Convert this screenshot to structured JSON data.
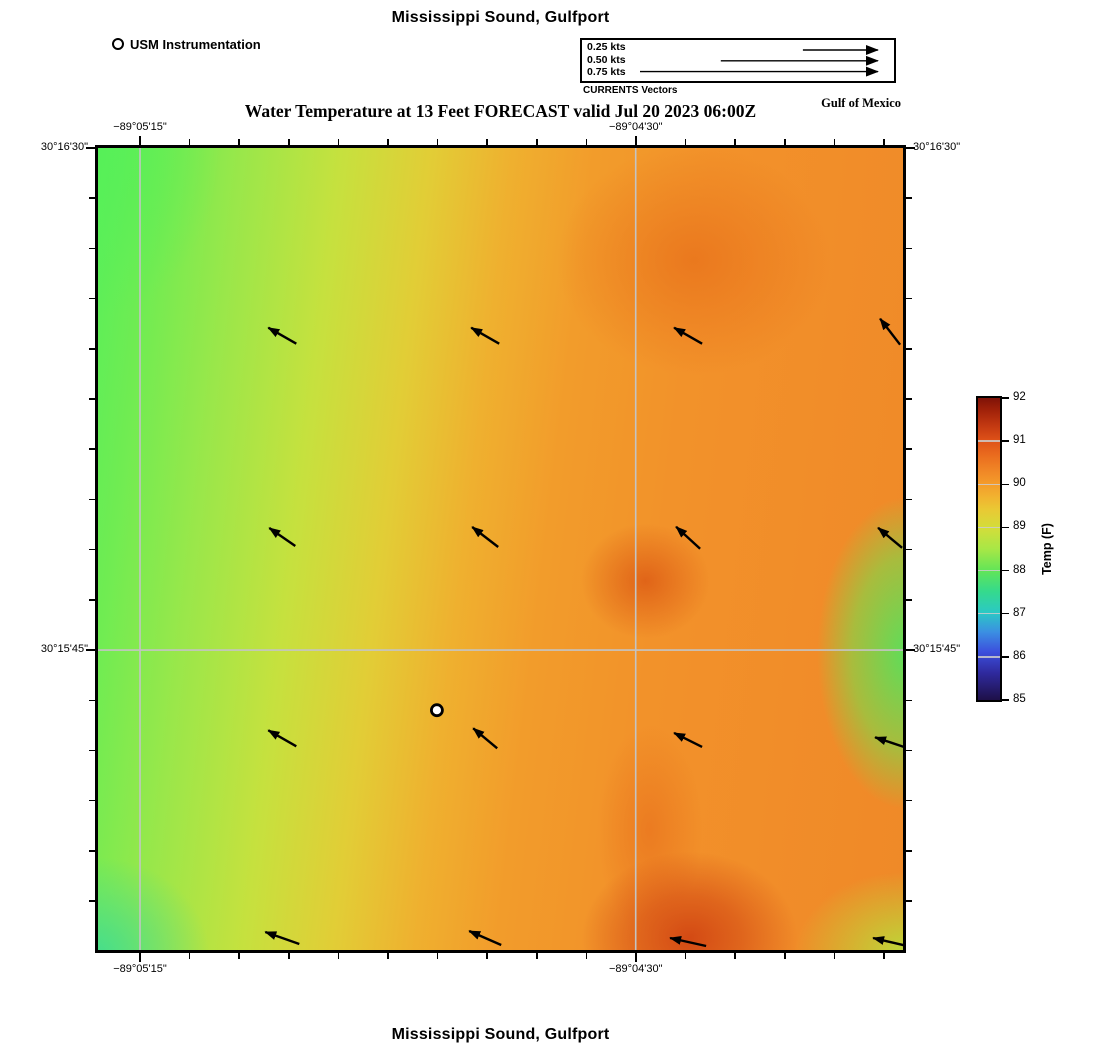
{
  "titles": {
    "top": "Mississippi Sound, Gulfport",
    "subtitle": "Water Temperature at 13 Feet FORECAST valid Jul 20 2023 06:00Z",
    "bottom": "Mississippi Sound, Gulfport",
    "gulf": "Gulf of Mexico"
  },
  "legend": {
    "instrument": "USM Instrumentation",
    "vectors": {
      "caption": "CURRENTS Vectors",
      "items": [
        {
          "label": "0.25 kts",
          "line_start_frac": 0.708
        },
        {
          "label": "0.50 kts",
          "line_start_frac": 0.445
        },
        {
          "label": "0.75 kts",
          "line_start_frac": 0.186
        }
      ],
      "line_end_frac": 0.987
    }
  },
  "axes": {
    "x": {
      "first_tick_frac": 0.0522,
      "step_frac": 0.06161,
      "count": 16,
      "major_indices": [
        0,
        10
      ],
      "labels": [
        {
          "text": "−89°05'15\"",
          "frac": 0.0522
        },
        {
          "text": "−89°04'30\"",
          "frac": 0.668
        }
      ]
    },
    "y": {
      "first_tick_frac": 0.0,
      "step_frac": 0.0626,
      "count": 16,
      "major_indices": [
        0,
        10
      ],
      "labels": [
        {
          "text": "30°16'30\"",
          "frac": 0.0
        },
        {
          "text": "30°15'45\"",
          "frac": 0.626
        }
      ]
    }
  },
  "map": {
    "gridlines_x_frac": [
      0.0522,
      0.668
    ],
    "gridlines_y_frac": [
      0.626
    ],
    "grid_color": "#c4c4c4",
    "station": {
      "name": "USM Instrumentation",
      "x_frac": 0.421,
      "y_frac": 0.701
    },
    "arrows": [
      {
        "fx": 0.229,
        "fy": 0.234,
        "dx": 14,
        "dy": 8
      },
      {
        "fx": 0.481,
        "fy": 0.234,
        "dx": 14,
        "dy": 8
      },
      {
        "fx": 0.733,
        "fy": 0.234,
        "dx": 14,
        "dy": 8
      },
      {
        "fx": 0.984,
        "fy": 0.229,
        "dx": 10,
        "dy": 13
      },
      {
        "fx": 0.229,
        "fy": 0.485,
        "dx": 13,
        "dy": 9
      },
      {
        "fx": 0.481,
        "fy": 0.485,
        "dx": 13,
        "dy": 10
      },
      {
        "fx": 0.733,
        "fy": 0.486,
        "dx": 12,
        "dy": 11
      },
      {
        "fx": 0.984,
        "fy": 0.486,
        "dx": 12,
        "dy": 10
      },
      {
        "fx": 0.229,
        "fy": 0.736,
        "dx": 14,
        "dy": 8
      },
      {
        "fx": 0.481,
        "fy": 0.736,
        "dx": 12,
        "dy": 10
      },
      {
        "fx": 0.733,
        "fy": 0.738,
        "dx": 14,
        "dy": 7
      },
      {
        "fx": 0.984,
        "fy": 0.741,
        "dx": 15,
        "dy": 5
      },
      {
        "fx": 0.229,
        "fy": 0.985,
        "dx": 17,
        "dy": 6
      },
      {
        "fx": 0.481,
        "fy": 0.985,
        "dx": 16,
        "dy": 7
      },
      {
        "fx": 0.733,
        "fy": 0.99,
        "dx": 18,
        "dy": 4
      },
      {
        "fx": 0.984,
        "fy": 0.99,
        "dx": 17,
        "dy": 4
      }
    ]
  },
  "colorbar": {
    "label": "Temp (F)",
    "tick_values": [
      92,
      91,
      90,
      89,
      88,
      87,
      86,
      85
    ]
  },
  "chart_data": {
    "type": "heatmap",
    "title": "Mississippi Sound, Gulfport",
    "subtitle": "Water Temperature at 13 Feet FORECAST valid Jul 20 2023 06:00Z",
    "region": "Gulf of Mexico",
    "x_axis": {
      "label": "Longitude",
      "tick_labels": [
        "−89°05'15\"",
        "−89°04'30\""
      ],
      "tick_fracs": [
        0.052,
        0.668
      ],
      "minor_tick_interval_frac": 0.0616
    },
    "y_axis": {
      "label": "Latitude",
      "tick_labels": [
        "30°16'30\"",
        "30°15'45\""
      ],
      "tick_fracs": [
        0.0,
        0.626
      ],
      "minor_tick_interval_frac": 0.0626
    },
    "colorbar": {
      "label": "Temp (F)",
      "min": 85,
      "max": 92,
      "tick_values": [
        85,
        86,
        87,
        88,
        89,
        90,
        91,
        92
      ]
    },
    "temperature_grid_F": {
      "note": "approximate values sampled from the color field; rows top to bottom, cols left to right at even spacing",
      "values": [
        [
          88.5,
          89.3,
          90.1,
          90.6,
          90.6,
          90.2
        ],
        [
          88.3,
          89.1,
          90.0,
          90.8,
          90.5,
          90.3
        ],
        [
          88.2,
          89.4,
          90.2,
          90.4,
          90.0,
          89.0
        ],
        [
          88.0,
          89.2,
          90.3,
          90.9,
          90.2,
          88.3
        ],
        [
          87.8,
          89.0,
          90.1,
          90.5,
          90.4,
          88.8
        ],
        [
          87.4,
          88.8,
          89.8,
          91.2,
          90.3,
          89.4
        ]
      ]
    },
    "current_vectors": {
      "grid": "4x4",
      "direction": "toward west-northwest",
      "approx_speed_kts": 0.5,
      "scale_reference_kts": [
        0.25,
        0.5,
        0.75
      ]
    },
    "station_marker": {
      "name": "USM Instrumentation",
      "x_frac": 0.421,
      "y_frac": 0.701
    }
  }
}
